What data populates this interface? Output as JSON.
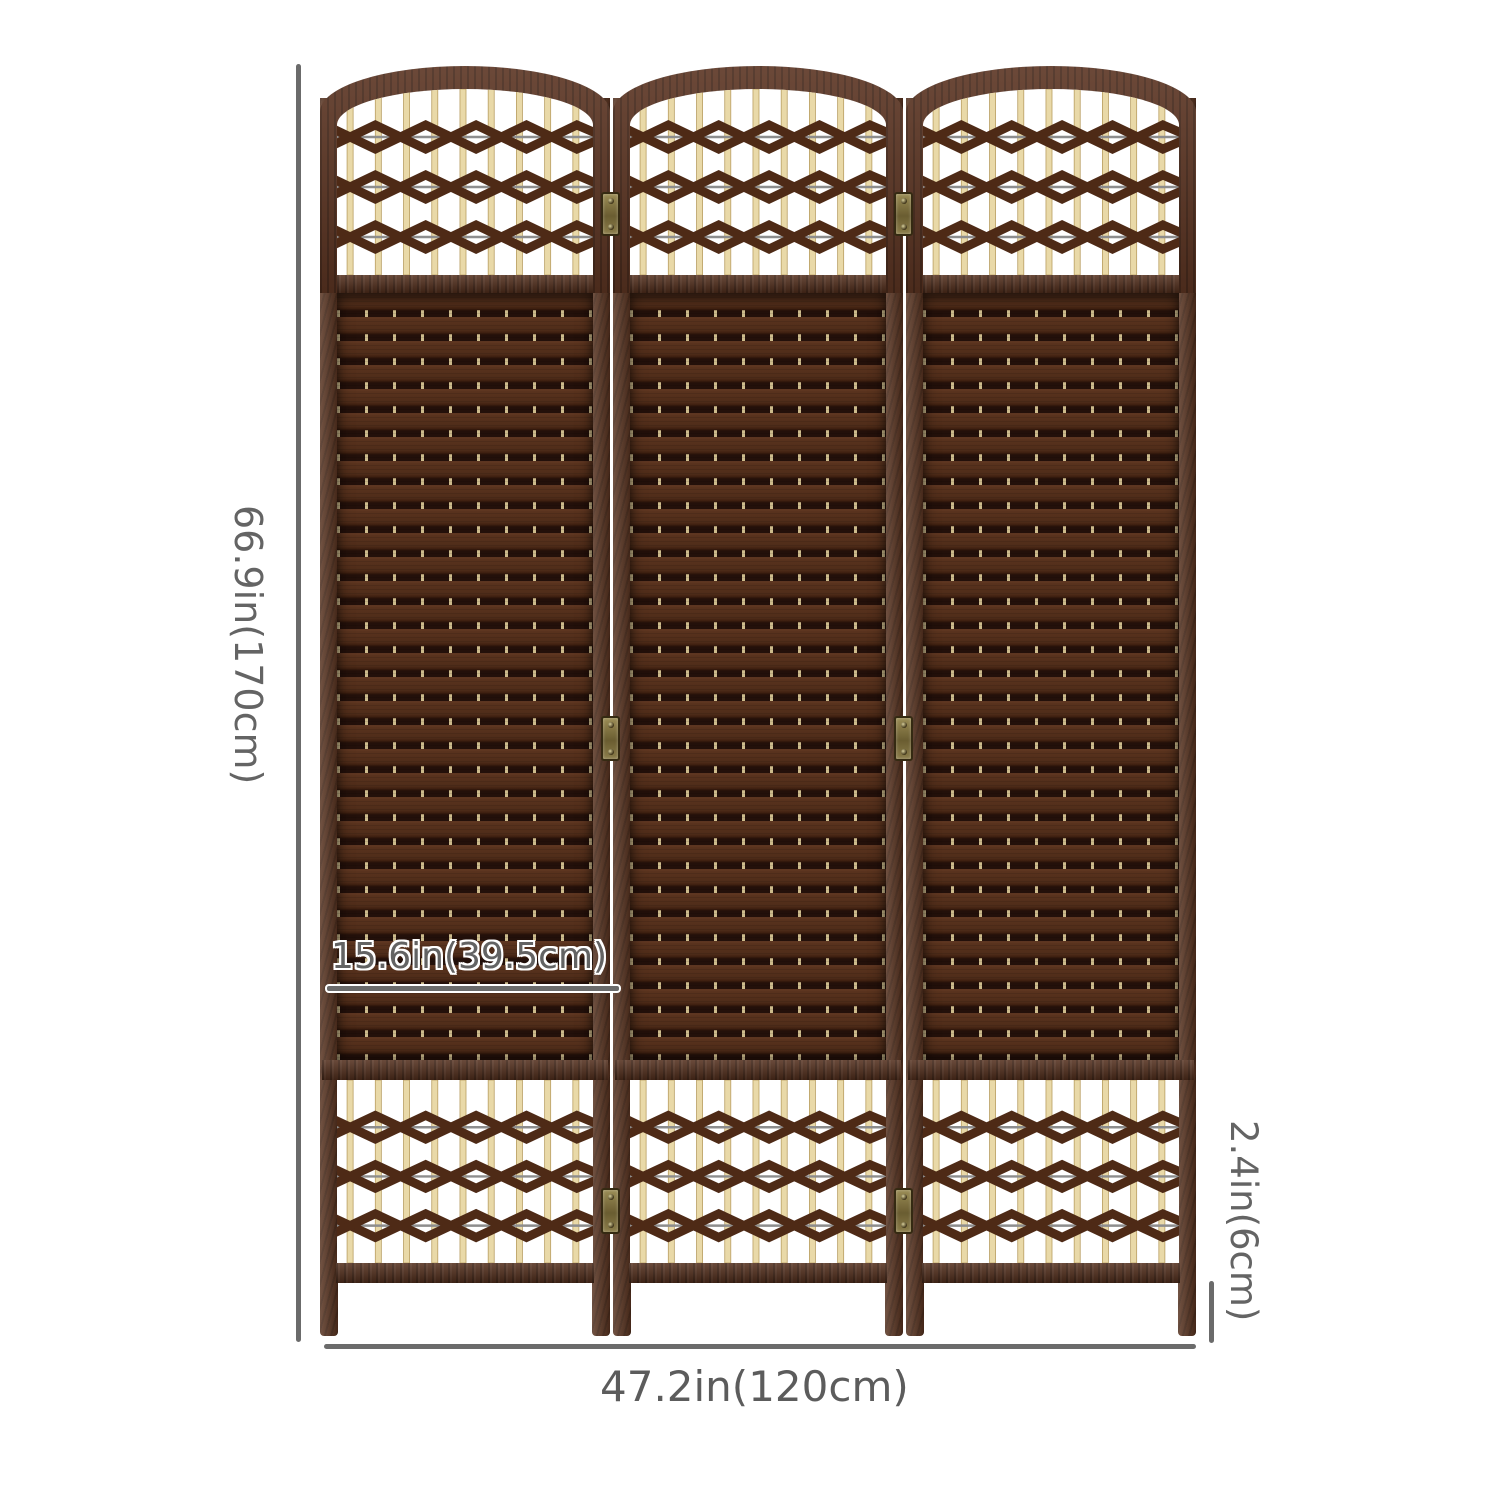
{
  "diagram": {
    "kind": "product-dimension-diagram",
    "background_color": "#ffffff",
    "product": {
      "panel_count": 3,
      "hinge_rows_per_joint": 3,
      "x_weave_rows_per_lattice": 3,
      "spindles_per_panel": 9
    }
  },
  "annotations": {
    "height_label": "66.9in(170cm)",
    "width_label": "47.2in(120cm)",
    "panel_width_label": "15.6in(39.5cm)",
    "foot_height_label": "2.4in(6cm)"
  },
  "colors": {
    "frame_brown": "#57321f",
    "arch_brown": "#5b3422",
    "weave_slat_brown": "#4f2c19",
    "weave_shadow": "#23100a",
    "stitch_cream": "#cdbb8c",
    "spindle_cream": "#e9d9a8",
    "x_weave_brown": "#4e2a16",
    "hinge_brass": "#8b7d4a",
    "dimension_gray": "#6b6b6b"
  }
}
